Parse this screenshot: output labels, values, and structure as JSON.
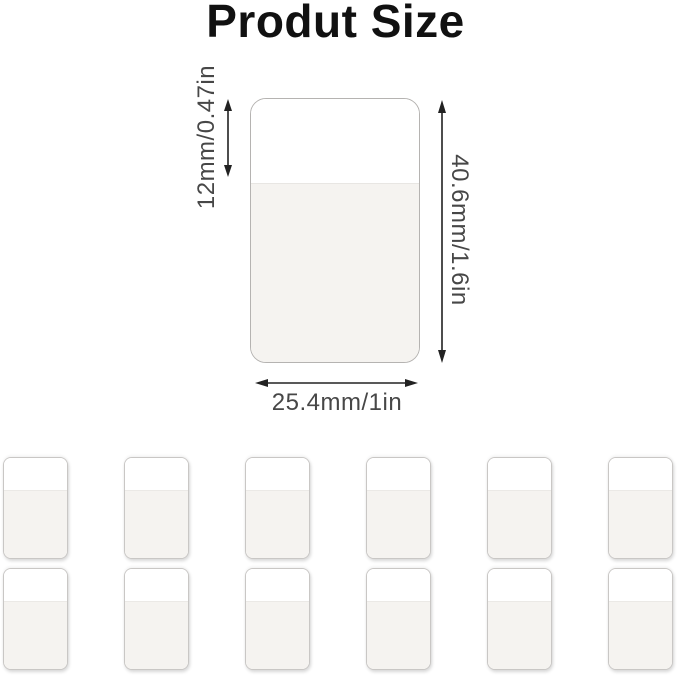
{
  "title": "Produt Size",
  "dimensions": {
    "top_section": "12mm/0.47in",
    "height": "40.6mm/1.6in",
    "width": "25.4mm/1in"
  },
  "tabs_grid": {
    "rows": 2,
    "columns": 6,
    "count": 12
  },
  "colors": {
    "background": "#ffffff",
    "title_text": "#111111",
    "dimension_text": "#474747",
    "arrow": "#222222",
    "tab_top_section": "#ffffff",
    "tab_body_section": "#f5f3f0",
    "tab_border": "#bcbab8"
  }
}
